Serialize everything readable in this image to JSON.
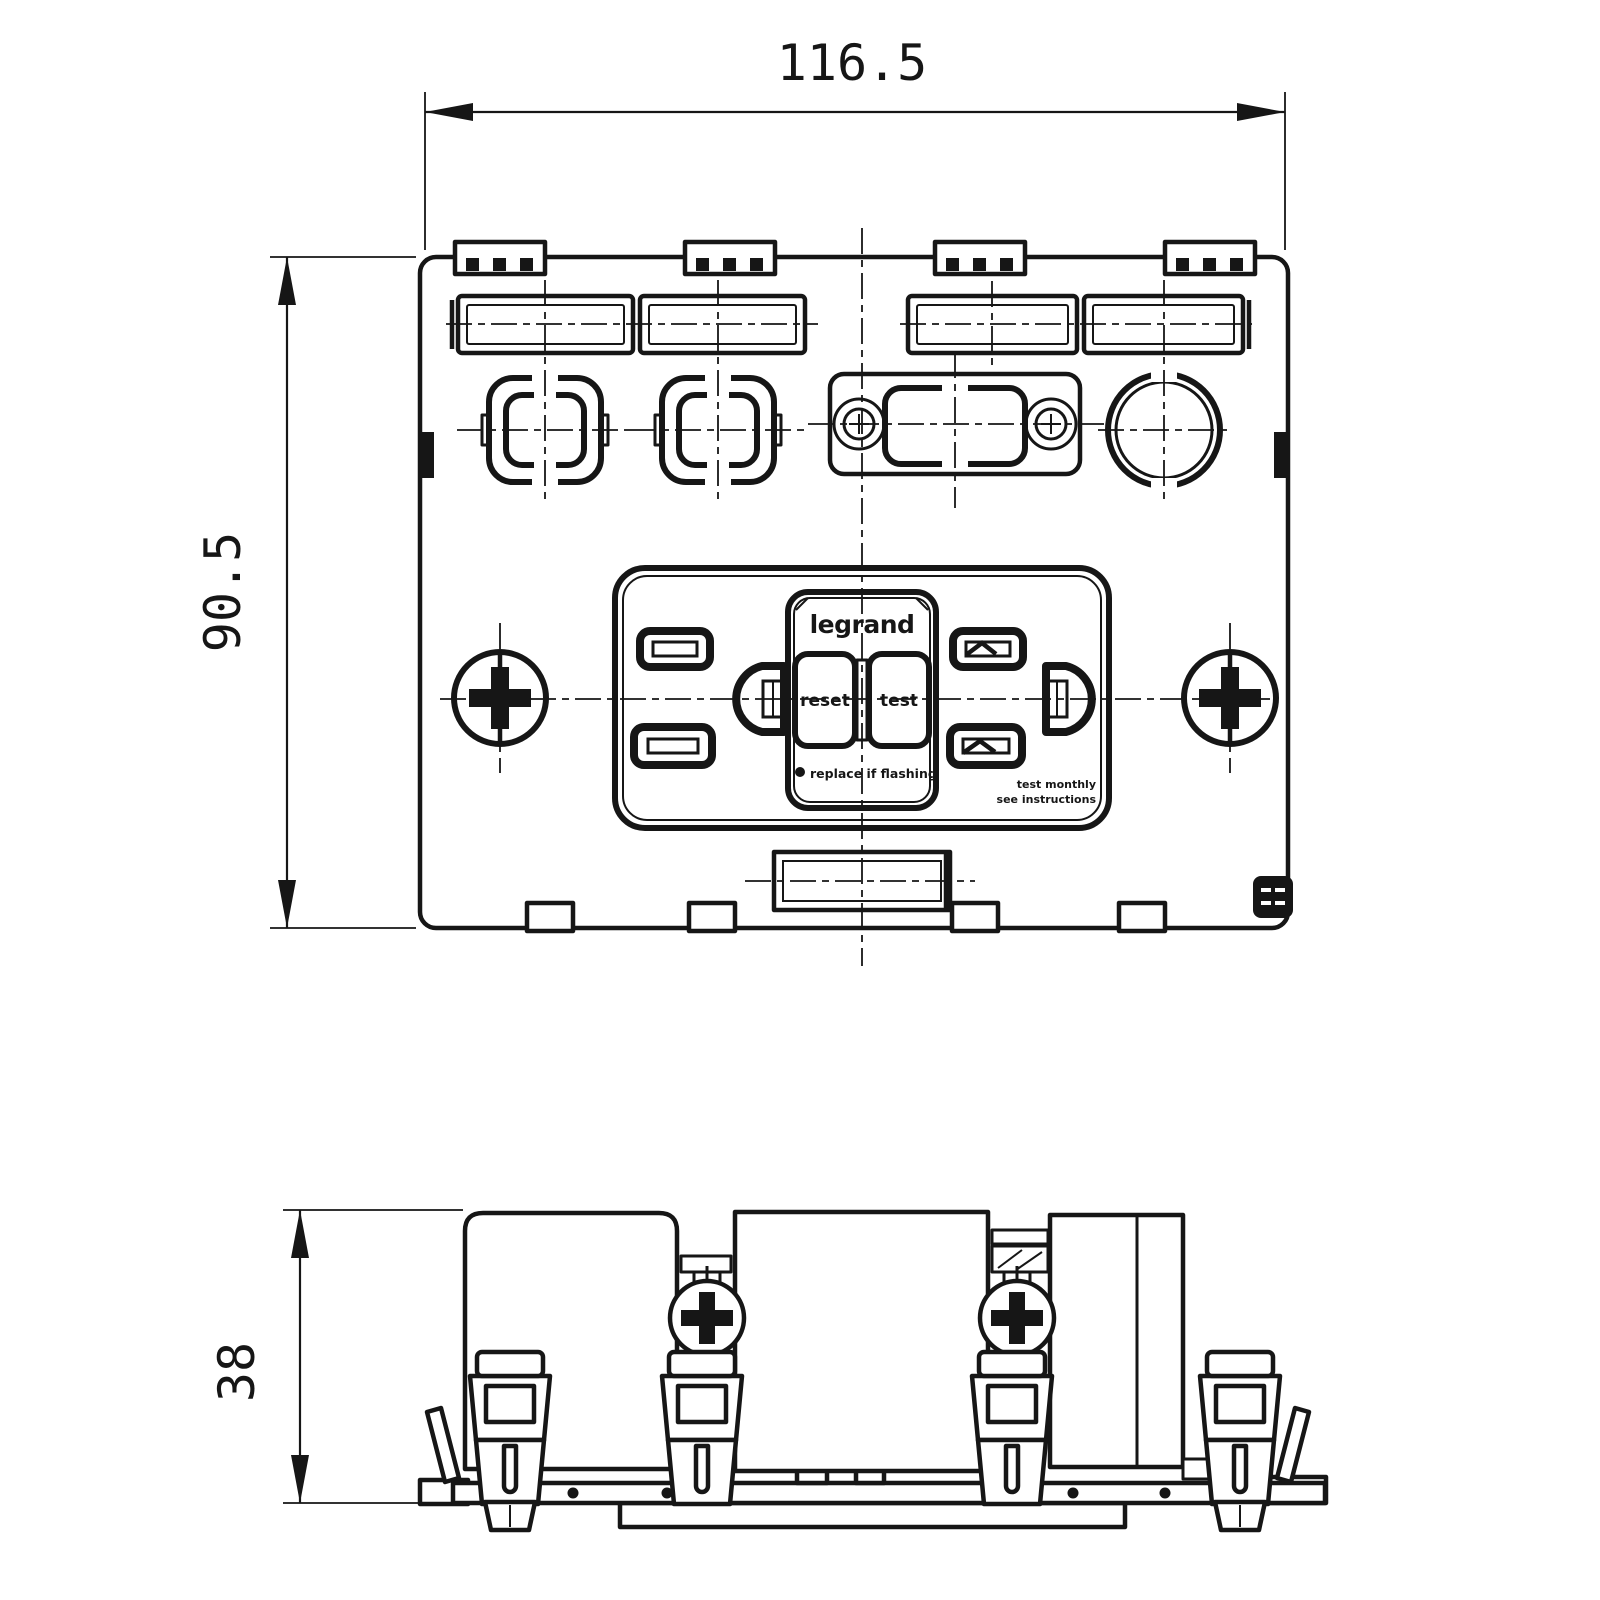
{
  "dimensions": {
    "width": "116.5",
    "height": "90.5",
    "depth": "38"
  },
  "device": {
    "brand": "legrand",
    "reset_button": "reset",
    "test_button": "test",
    "indicator_note": "replace if flashing",
    "corner_note_line1": "test monthly",
    "corner_note_line2": "see instructions"
  },
  "colors": {
    "line": "#161616",
    "background": "#ffffff"
  }
}
